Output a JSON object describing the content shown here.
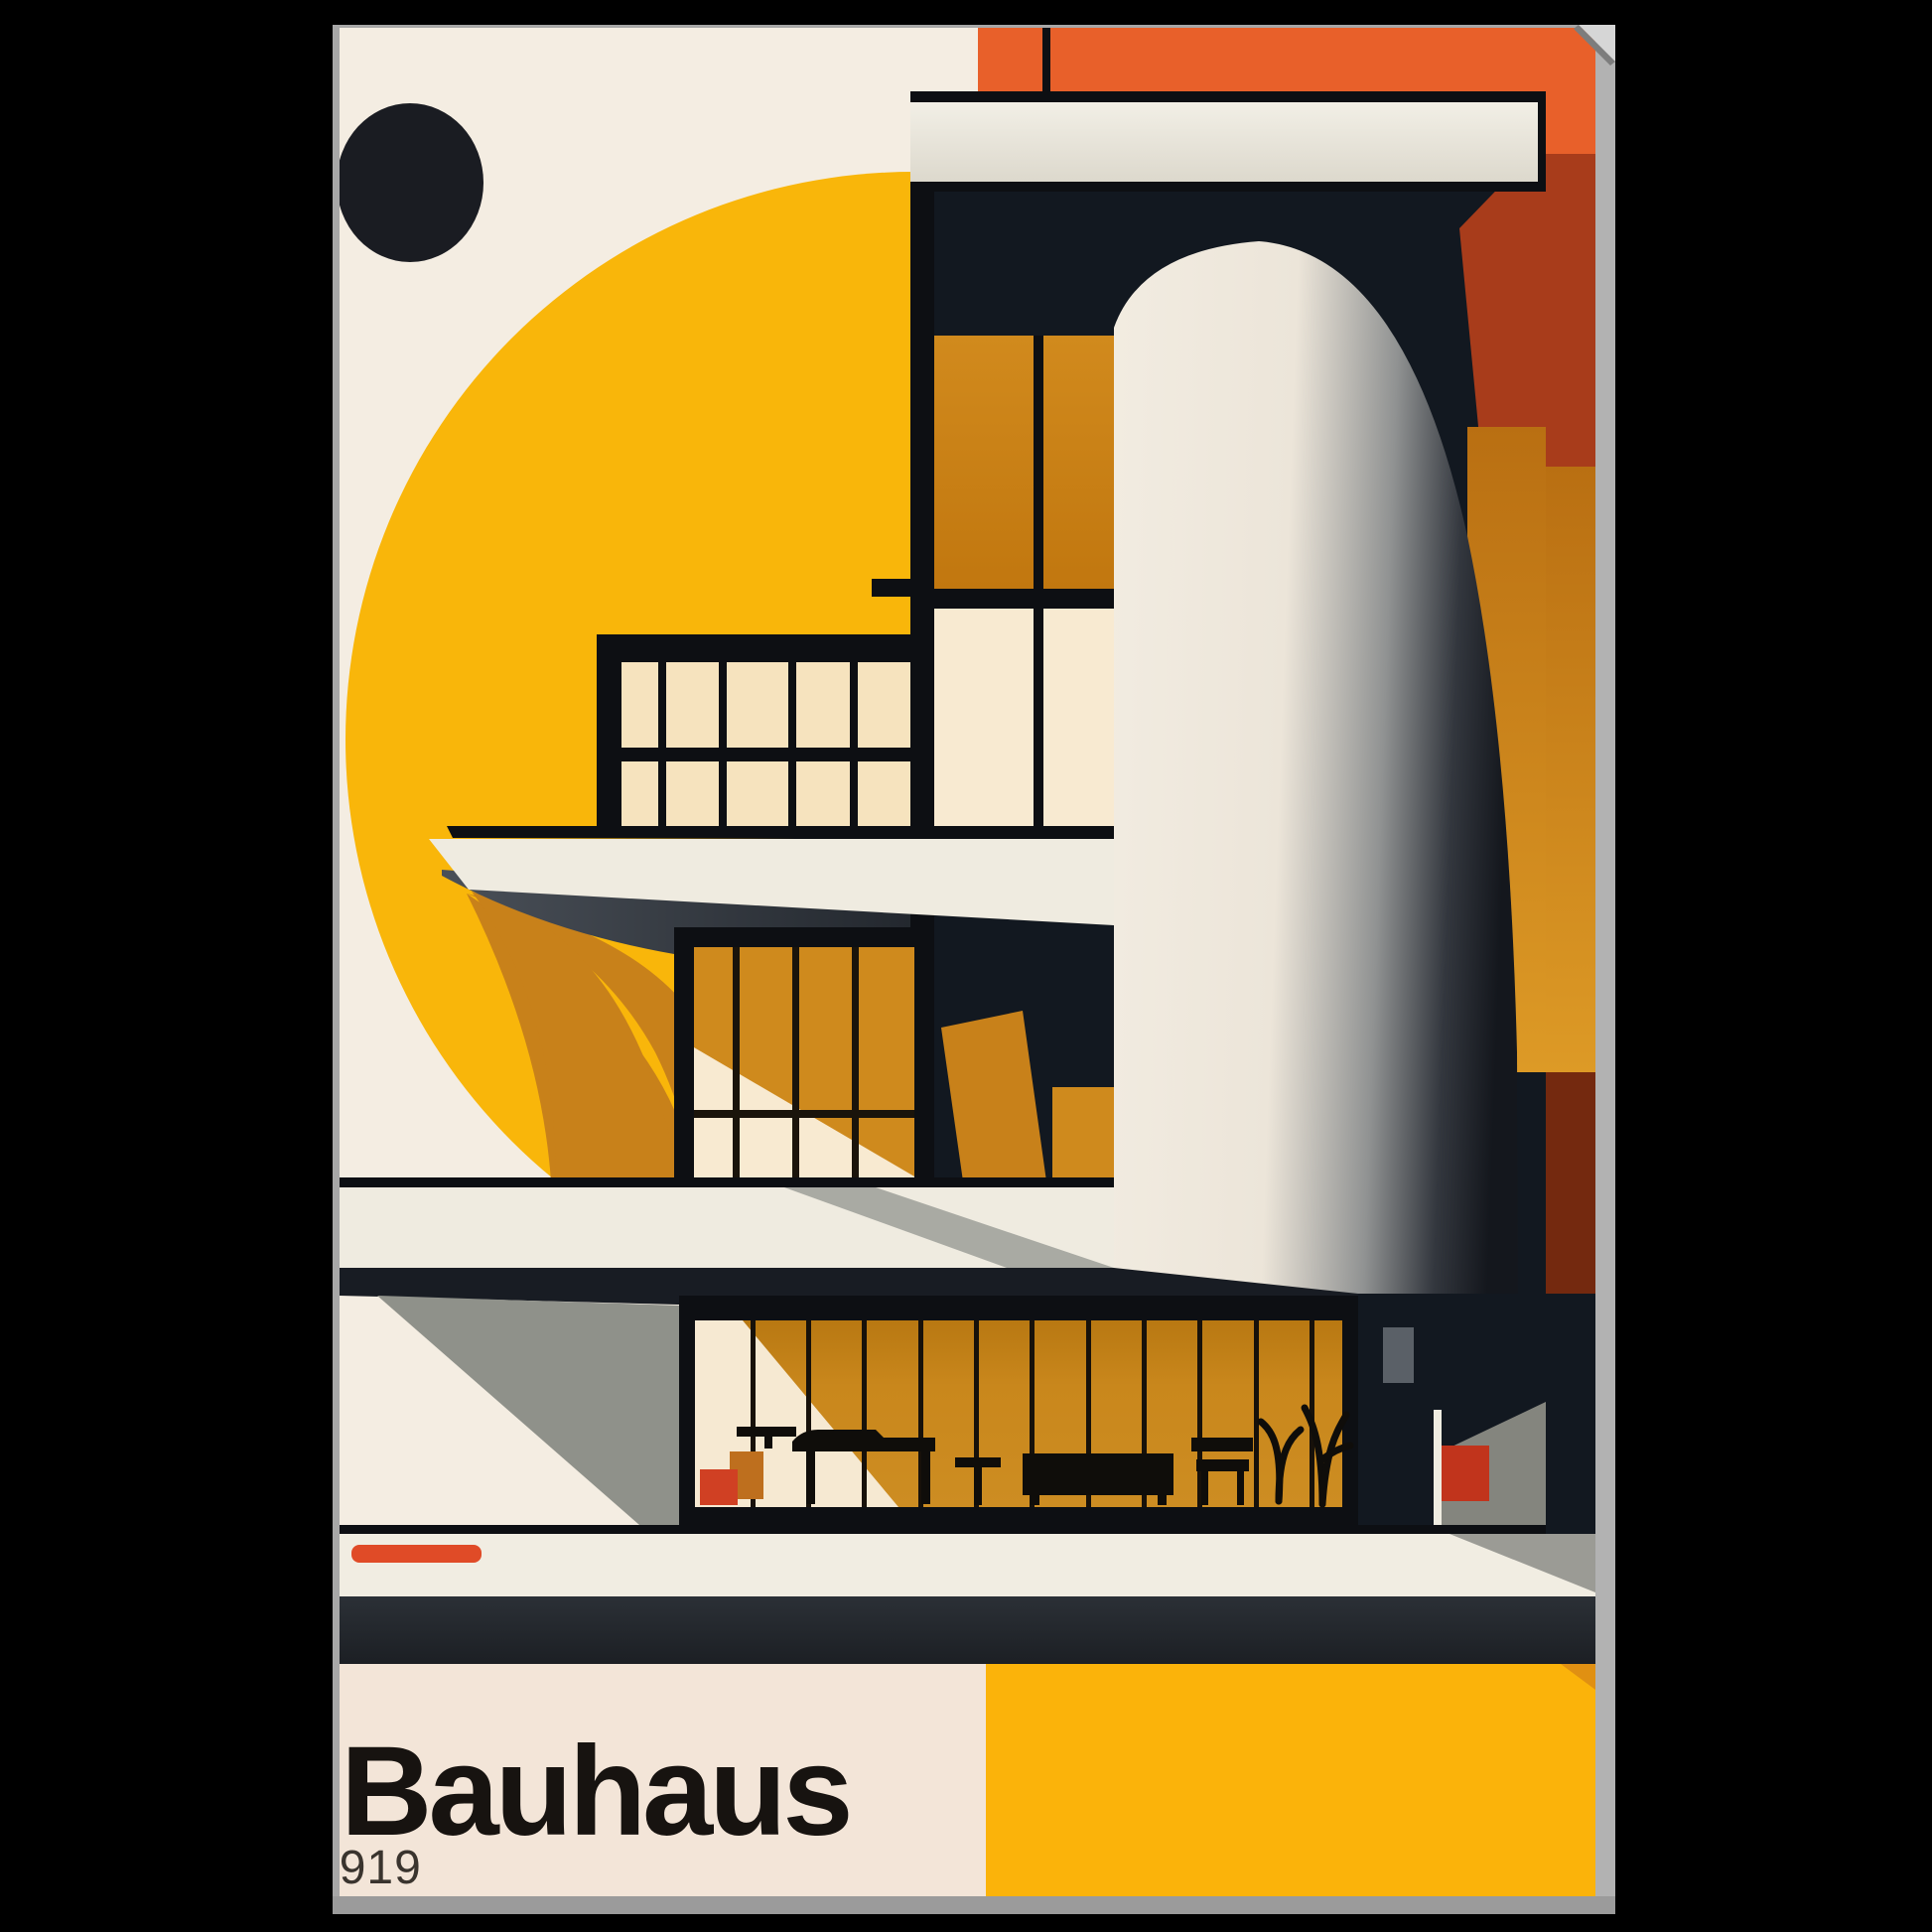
{
  "poster": {
    "title": "Bauhaus",
    "year": "1919",
    "description": "Bauhaus 1919 architecture art print, framed poster mockup on black background"
  },
  "palette": {
    "background_black": "#000000",
    "frame_gray": "#a7a7a7",
    "frame_gray_right": "#b2b2b2",
    "frame_gray_bottom": "#9b9b9b",
    "cream_top": "#f4ede2",
    "cream_bottom": "#f3e5d8",
    "yellow_circle": "#f9b60a",
    "yellow_block": "#fbb30a",
    "orange_top": "#e8602a",
    "maroon_shadow": "#a83c1b",
    "maroon_deep": "#74290f",
    "amber_window": "#cf8a1d",
    "amber_dark": "#c8811a",
    "navy_wall": "#121820",
    "ink_black": "#0d0f13",
    "beam_white": "#efece3",
    "slab_white": "#efebe0",
    "sill_white": "#f1ede2",
    "charcoal_band": "#22262b",
    "gray_plane": "#8f918a",
    "pane_light": "#f6e3be",
    "pane_pale": "#f8ead1",
    "red_accent": "#e04b27",
    "dark_circle": "#1a1c22",
    "title_color": "#171310",
    "year_color": "#3a342e"
  }
}
